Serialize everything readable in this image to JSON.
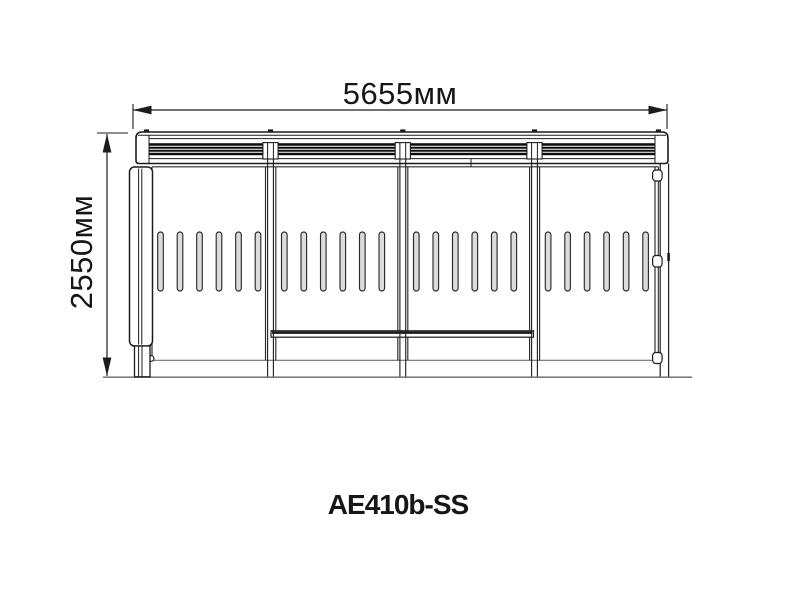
{
  "drawing": {
    "model_label": "AE410b-SS",
    "dimensions": {
      "width_label": "5655мм",
      "height_label": "2550мм"
    },
    "structure": {
      "bay_count": 4,
      "slots_per_bay": 6,
      "grille_sections": 4,
      "grille_slats_per_section": 4,
      "support_posts": 3,
      "right_side_tabs": 3,
      "roof_ticks": 5
    },
    "colors": {
      "background": "#ffffff",
      "line": "#1c1c1c",
      "panel_line": "#2a2a2a",
      "light_line": "#6f6f6f",
      "ground": "#7d7d7d",
      "grille_fill": "#0e0e0e",
      "slot_fill": "#dcdcdc",
      "text": "#161616"
    }
  }
}
